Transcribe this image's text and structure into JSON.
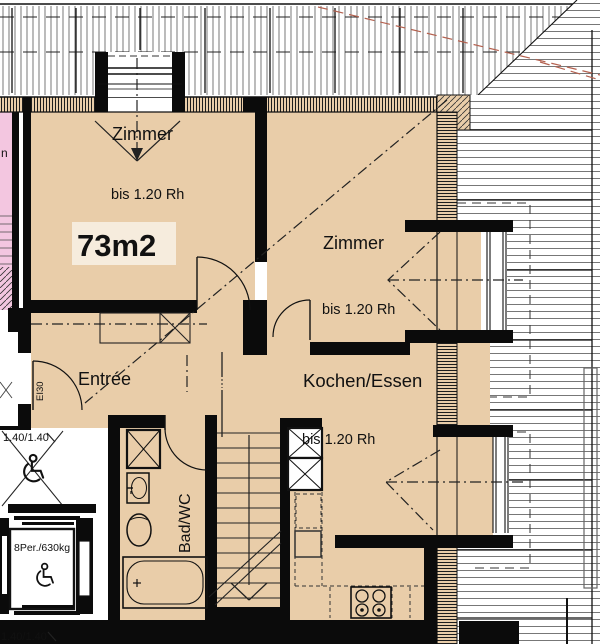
{
  "title": "Attic apartment floor plan",
  "colors": {
    "floor_tan": "#e9cda9",
    "floor_highlight": "#f6ecdd",
    "neighbor_pink": "#f3c6e0",
    "wall_black": "#0b0b0b",
    "hatch_gray": "#555555",
    "red_dash_line": "#b4614f"
  },
  "labels": {
    "room_top": {
      "name": "Zimmer",
      "height_note": "bis 1.20 Rh"
    },
    "area_label": "73m2",
    "room_right": {
      "name": "Zimmer",
      "height_note": "bis 1.20 Rh"
    },
    "kitchen": {
      "name": "Kochen/Essen",
      "height_note": "bis 1.20 Rh"
    },
    "entree": "Entrée",
    "door_fire_rating": "EI30",
    "bathroom": "Bad/WC",
    "elevator_capacity": "8Per./630kg",
    "clearance_upper": "1.40/1.40",
    "clearance_lower": "1.40/1.40",
    "neighbor_text_fragment": "n"
  },
  "icons": {
    "wheelchair": "accessible turning / lift symbol",
    "stove": "4-plate cooktop",
    "bathtub": "bathtub",
    "toilet": "WC",
    "washbasin": "basin",
    "shaft": "duct box with X",
    "stairs": "stair run with down arrow"
  }
}
